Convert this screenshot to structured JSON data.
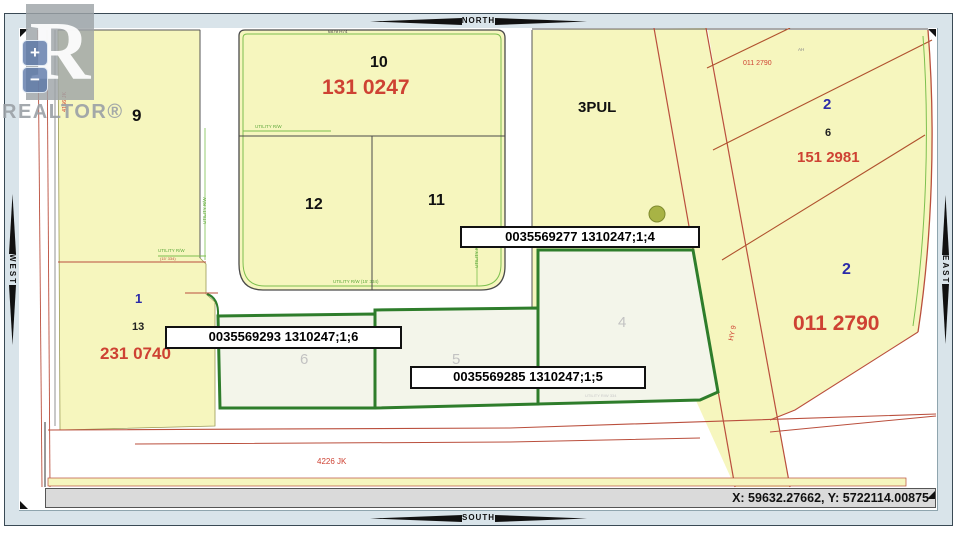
{
  "viewer": {
    "compass": {
      "north": "NORTH",
      "south": "SOUTH",
      "east": "EAST",
      "west": "WEST"
    },
    "zoom_controls": {
      "zoom_in_label": "+",
      "zoom_out_label": "−"
    },
    "status_bar": {
      "coordinates_text": "X: 59632.27662, Y: 5722114.00875"
    },
    "watermark": {
      "logo_letter": "R",
      "brand_text": "REALTOR®"
    }
  },
  "map": {
    "callout_boxes": [
      {
        "text": "0035569277 1310247;1;4"
      },
      {
        "text": "0035569293 1310247;1;6"
      },
      {
        "text": "0035569285 1310247;1;5"
      }
    ],
    "labels": [
      {
        "text": "9",
        "role": "lot-number"
      },
      {
        "text": "1",
        "role": "lot-number"
      },
      {
        "text": "13",
        "role": "lot-number"
      },
      {
        "text": "231 0740",
        "role": "plan-number"
      },
      {
        "text": "10",
        "role": "lot-number"
      },
      {
        "text": "131 0247",
        "role": "plan-number"
      },
      {
        "text": "12",
        "role": "lot-number"
      },
      {
        "text": "11",
        "role": "lot-number"
      },
      {
        "text": "3PUL",
        "role": "lot-number"
      },
      {
        "text": "6879 H74",
        "role": "annotation"
      },
      {
        "text": "UTILITY R/W",
        "role": "utility-annotation"
      },
      {
        "text": "UTILITY R/W   (15' 334)",
        "role": "utility-annotation"
      },
      {
        "text": "UTILITY R/W",
        "role": "utility-annotation"
      },
      {
        "text": "UTILITY R/W",
        "role": "utility-annotation"
      },
      {
        "text": "UTILITY R/W",
        "role": "utility-annotation"
      },
      {
        "text": "(15' 334)",
        "role": "utility-annotation"
      },
      {
        "text": "4156 JK",
        "role": "road-name"
      },
      {
        "text": "4226 JK",
        "role": "road-name"
      },
      {
        "text": "HY 9",
        "role": "road-name"
      },
      {
        "text": "011 2790",
        "role": "plan-number"
      },
      {
        "text": "AH",
        "role": "annotation"
      },
      {
        "text": "2",
        "role": "block-number"
      },
      {
        "text": "6",
        "role": "lot-number"
      },
      {
        "text": "151 2981",
        "role": "plan-number"
      },
      {
        "text": "2",
        "role": "block-number"
      },
      {
        "text": "011 2790",
        "role": "plan-number"
      },
      {
        "text": "6",
        "role": "lot-number-faint"
      },
      {
        "text": "5",
        "role": "lot-number-faint"
      },
      {
        "text": "4",
        "role": "lot-number-faint"
      },
      {
        "text": "UTILITY R/W      334",
        "role": "utility-annotation"
      }
    ]
  },
  "colors": {
    "parcel_fill": "#F6F6BE",
    "subdivision_fill": "#F3F5EA",
    "selected_boundary_green": "#2E7D2B",
    "utility_green": "#7CBF4E",
    "road_red": "#BA4F3D",
    "plan_text_red": "#CE4233",
    "block_text_blue": "#2B2BA8",
    "faint_lot_gray": "#C2C2C2",
    "compass_bar": "#D9E4EA",
    "status_bar_bg": "#DADADA",
    "frame_border": "#3A4A55"
  }
}
